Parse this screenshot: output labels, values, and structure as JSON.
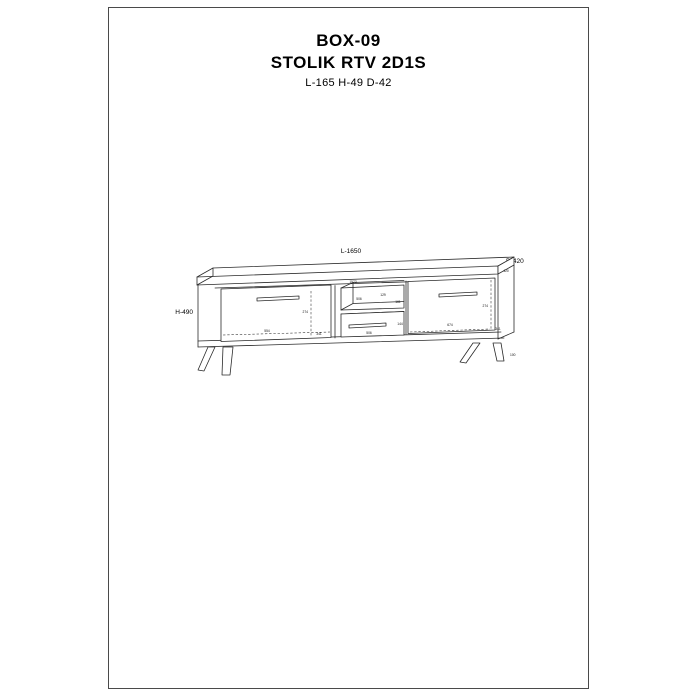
{
  "header": {
    "model": "BOX-09",
    "product_name": "STOLIK RTV 2D1S",
    "overall_dimensions": "L-165 H-49 D-42"
  },
  "drawing": {
    "dim_length": "L-1650",
    "dim_depth": "D-420",
    "dim_height": "H-490",
    "top_panel_width": "1573",
    "top_panel_depth": "420",
    "left_door_height": "274",
    "left_door_width": "554",
    "left_door_diag": "341",
    "niche_width": "506",
    "niche_height": "129",
    "niche_depth": "161",
    "drawer_height": "144",
    "drawer_width": "506",
    "right_door_height": "274",
    "right_door_width": "674",
    "right_door_diag": "341",
    "leg_height": "100"
  },
  "colors": {
    "line": "#2a2a2a",
    "frame_border": "#4a4a4a",
    "background": "#ffffff"
  }
}
